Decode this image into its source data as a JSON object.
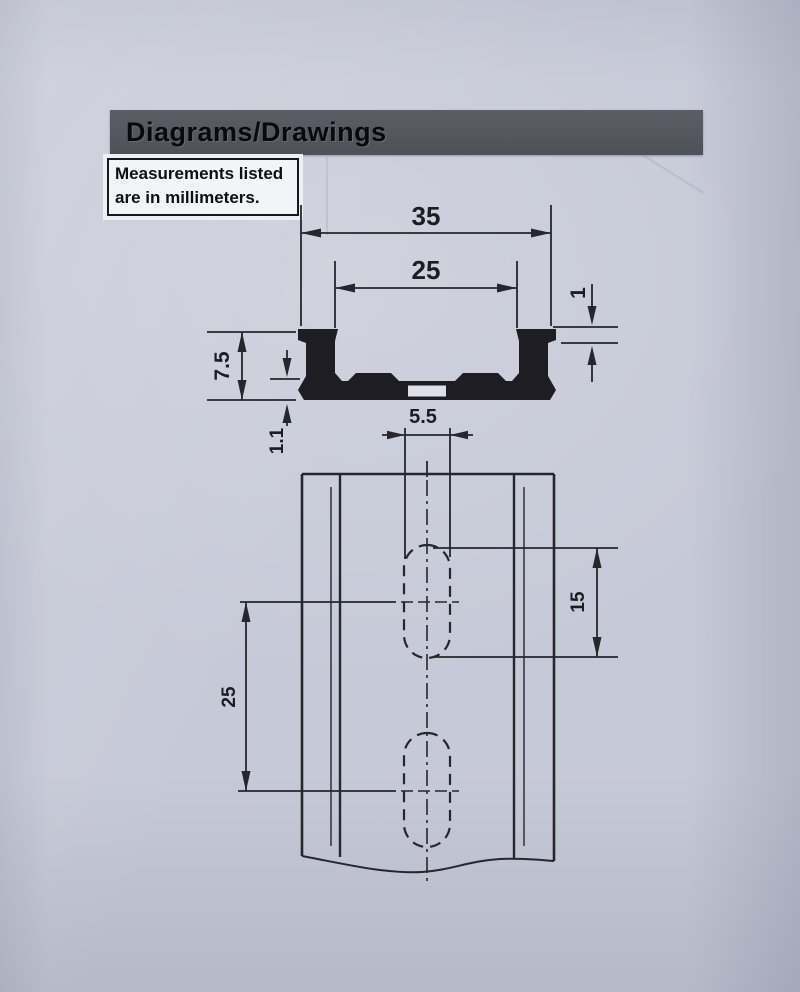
{
  "page": {
    "header_title": "Diagrams/Drawings",
    "note_line1": "Measurements listed",
    "note_line2": "are in millimeters."
  },
  "dimensions": {
    "overall_width": "35",
    "opening_width": "25",
    "lip_thickness": "1",
    "rail_height": "7.5",
    "base_thickness": "1.1",
    "slot_width": "5.5",
    "slot_length": "15",
    "slot_spacing": "25"
  },
  "colors": {
    "paper": "#c6c9d7",
    "header_bar": "#54565e",
    "ink": "#26262c",
    "note_background": "#f3f4f7"
  }
}
